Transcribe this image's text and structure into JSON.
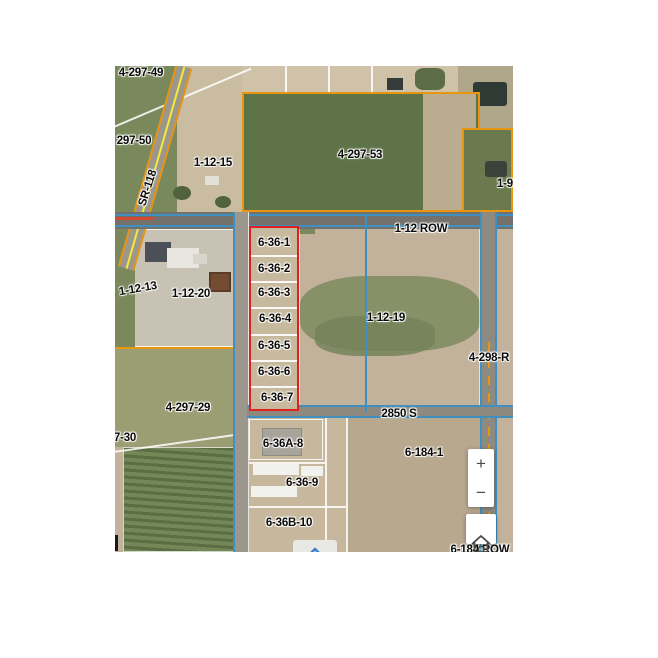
{
  "controls": {
    "zoom_in": "+",
    "zoom_out": "−"
  },
  "colors": {
    "boundary_blue": "#3f8fc0",
    "boundary_orange": "#e8950f",
    "highlight_red": "#e21f1f",
    "road_yellow": "#f2ea38"
  },
  "map": {
    "labels": [
      {
        "id": "parcel-4-297-49",
        "text": "4-297-49",
        "x": 26,
        "y": 7
      },
      {
        "id": "parcel-297-50",
        "text": "297-50",
        "x": 19,
        "y": 75
      },
      {
        "id": "parcel-1-12-15",
        "text": "1-12-15",
        "x": 98,
        "y": 97
      },
      {
        "id": "road-sr-118",
        "text": "SR-118",
        "x": 33,
        "y": 122,
        "rot": -72
      },
      {
        "id": "parcel-4-297-53",
        "text": "4-297-53",
        "x": 245,
        "y": 89
      },
      {
        "id": "road-1-12-row",
        "text": "1-12 ROW",
        "x": 306,
        "y": 163
      },
      {
        "id": "parcel-1-9",
        "text": "1-9",
        "x": 390,
        "y": 118
      },
      {
        "id": "parcel-1-12-13",
        "text": "1-12-13",
        "x": 23,
        "y": 223,
        "rot": -10
      },
      {
        "id": "parcel-1-12-20",
        "text": "1-12-20",
        "x": 76,
        "y": 228
      },
      {
        "id": "parcel-6-36-1",
        "text": "6-36-1",
        "x": 159,
        "y": 177
      },
      {
        "id": "parcel-6-36-2",
        "text": "6-36-2",
        "x": 159,
        "y": 203
      },
      {
        "id": "parcel-6-36-3",
        "text": "6-36-3",
        "x": 159,
        "y": 227
      },
      {
        "id": "parcel-6-36-4",
        "text": "6-36-4",
        "x": 160,
        "y": 253
      },
      {
        "id": "parcel-6-36-5",
        "text": "6-36-5",
        "x": 159,
        "y": 280
      },
      {
        "id": "parcel-6-36-6",
        "text": "6-36-6",
        "x": 159,
        "y": 306
      },
      {
        "id": "parcel-6-36-7",
        "text": "6-36-7",
        "x": 162,
        "y": 332
      },
      {
        "id": "parcel-1-12-19",
        "text": "1-12-19",
        "x": 271,
        "y": 252
      },
      {
        "id": "parcel-4-298-r",
        "text": "4-298-R",
        "x": 374,
        "y": 292
      },
      {
        "id": "parcel-4-297-29",
        "text": "4-297-29",
        "x": 73,
        "y": 342
      },
      {
        "id": "road-2850-s",
        "text": "2850 S",
        "x": 284,
        "y": 348
      },
      {
        "id": "parcel-297-30",
        "text": "7-30",
        "x": 10,
        "y": 372
      },
      {
        "id": "parcel-6-36a-8",
        "text": "6-36A-8",
        "x": 168,
        "y": 378
      },
      {
        "id": "parcel-6-36-9",
        "text": "6-36-9",
        "x": 187,
        "y": 417
      },
      {
        "id": "parcel-6-36b-10",
        "text": "6-36B-10",
        "x": 174,
        "y": 457
      },
      {
        "id": "parcel-6-184-1",
        "text": "6-184-1",
        "x": 309,
        "y": 387
      },
      {
        "id": "road-6-184-row",
        "text": "6-184 ROW",
        "x": 365,
        "y": 484
      }
    ]
  }
}
